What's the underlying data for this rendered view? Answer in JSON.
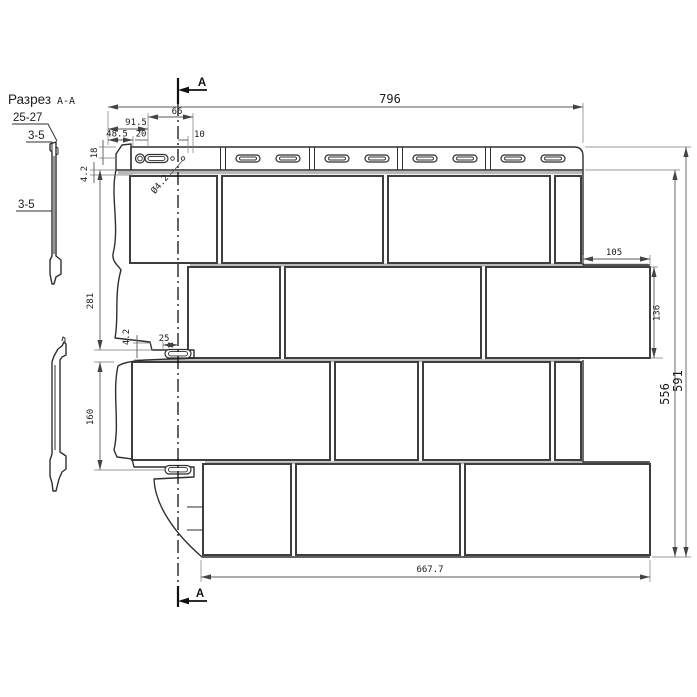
{
  "labels": {
    "view_title": "Разрез",
    "view_title_suffix": "А-А",
    "wall_thickness_range": "25-27",
    "thickness_top": "3-5",
    "thickness_side": "3-5",
    "section_marker": "А"
  },
  "dims": {
    "panel_width": "796",
    "offset_66": "66",
    "offset_91_5": "91.5",
    "offset_48_5": "48.5",
    "offset_20": "20",
    "offset_10": "10",
    "height_18": "18",
    "gap_4_2_top": "4.2",
    "hole_diameter": "Ø4.2",
    "height_281": "281",
    "offset_25": "25",
    "gap_4_2_mid": "4.2",
    "height_160": "160",
    "overhang_105": "105",
    "brick_height_136": "136",
    "panel_height_556": "556",
    "panel_height_591": "591",
    "bottom_width_667_7": "667.7"
  }
}
